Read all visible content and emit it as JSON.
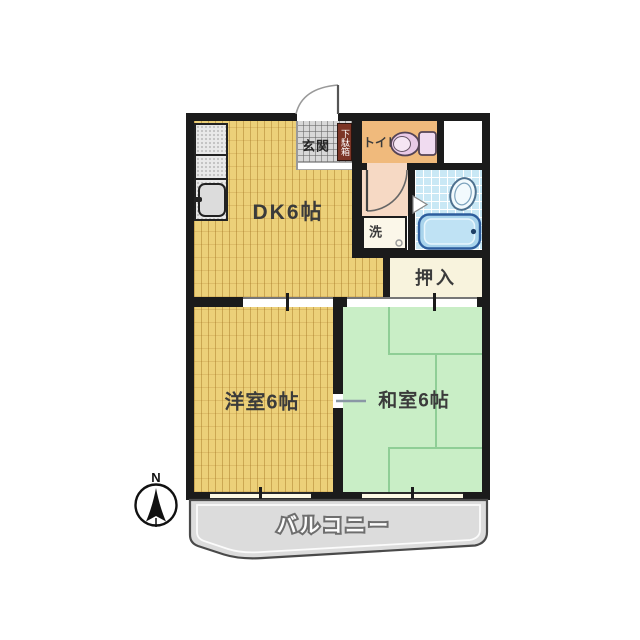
{
  "rooms": {
    "dk": {
      "label": "DK6帖"
    },
    "western": {
      "label": "洋室6帖"
    },
    "japanese": {
      "label": "和室6帖"
    },
    "closet": {
      "label": "押入"
    },
    "entrance": {
      "label": "玄関"
    },
    "shoe_cabinet": {
      "label": "下駄箱"
    },
    "toilet": {
      "label": "トイレ"
    },
    "laundry": {
      "label": "洗"
    },
    "balcony": {
      "label": "バルコニー"
    }
  },
  "compass": {
    "north_label": "N"
  },
  "colors": {
    "wall": "#1b1b1b",
    "wood_floor": "#ecd079",
    "tatami": "#c9eec6",
    "entrance_tile": "#d8d8d8",
    "toilet_room": "#f0ba7c",
    "hallway": "#f6d9c4",
    "laundry_box": "#fbf7e9",
    "bath_tile": "#c9e8f5",
    "bathtub": "#a9d4ec",
    "closet": "#f8f3dd",
    "shoe_cabinet": "#7c3526",
    "balcony": "#dcdcdc",
    "toilet_fixture": "#e8c9e6"
  }
}
